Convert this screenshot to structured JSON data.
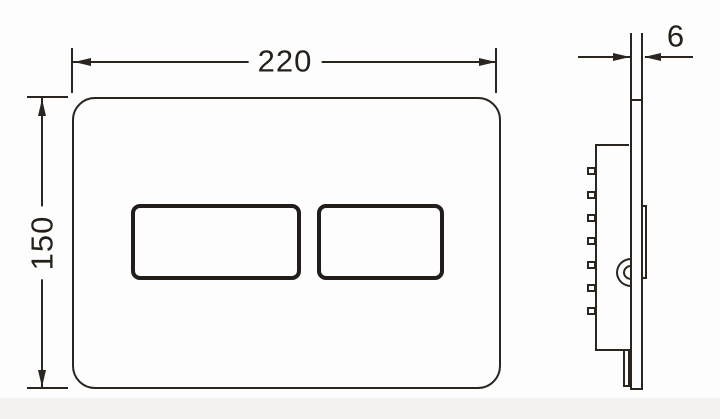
{
  "drawing": {
    "colors": {
      "line": "#2b2520",
      "button_line": "#221d1a",
      "background": "#fdfdfd",
      "footer_band": "#f3f2ef"
    },
    "dimensions": {
      "width": {
        "label": "220"
      },
      "height": {
        "label": "150"
      },
      "thickness": {
        "label": "6"
      }
    }
  }
}
